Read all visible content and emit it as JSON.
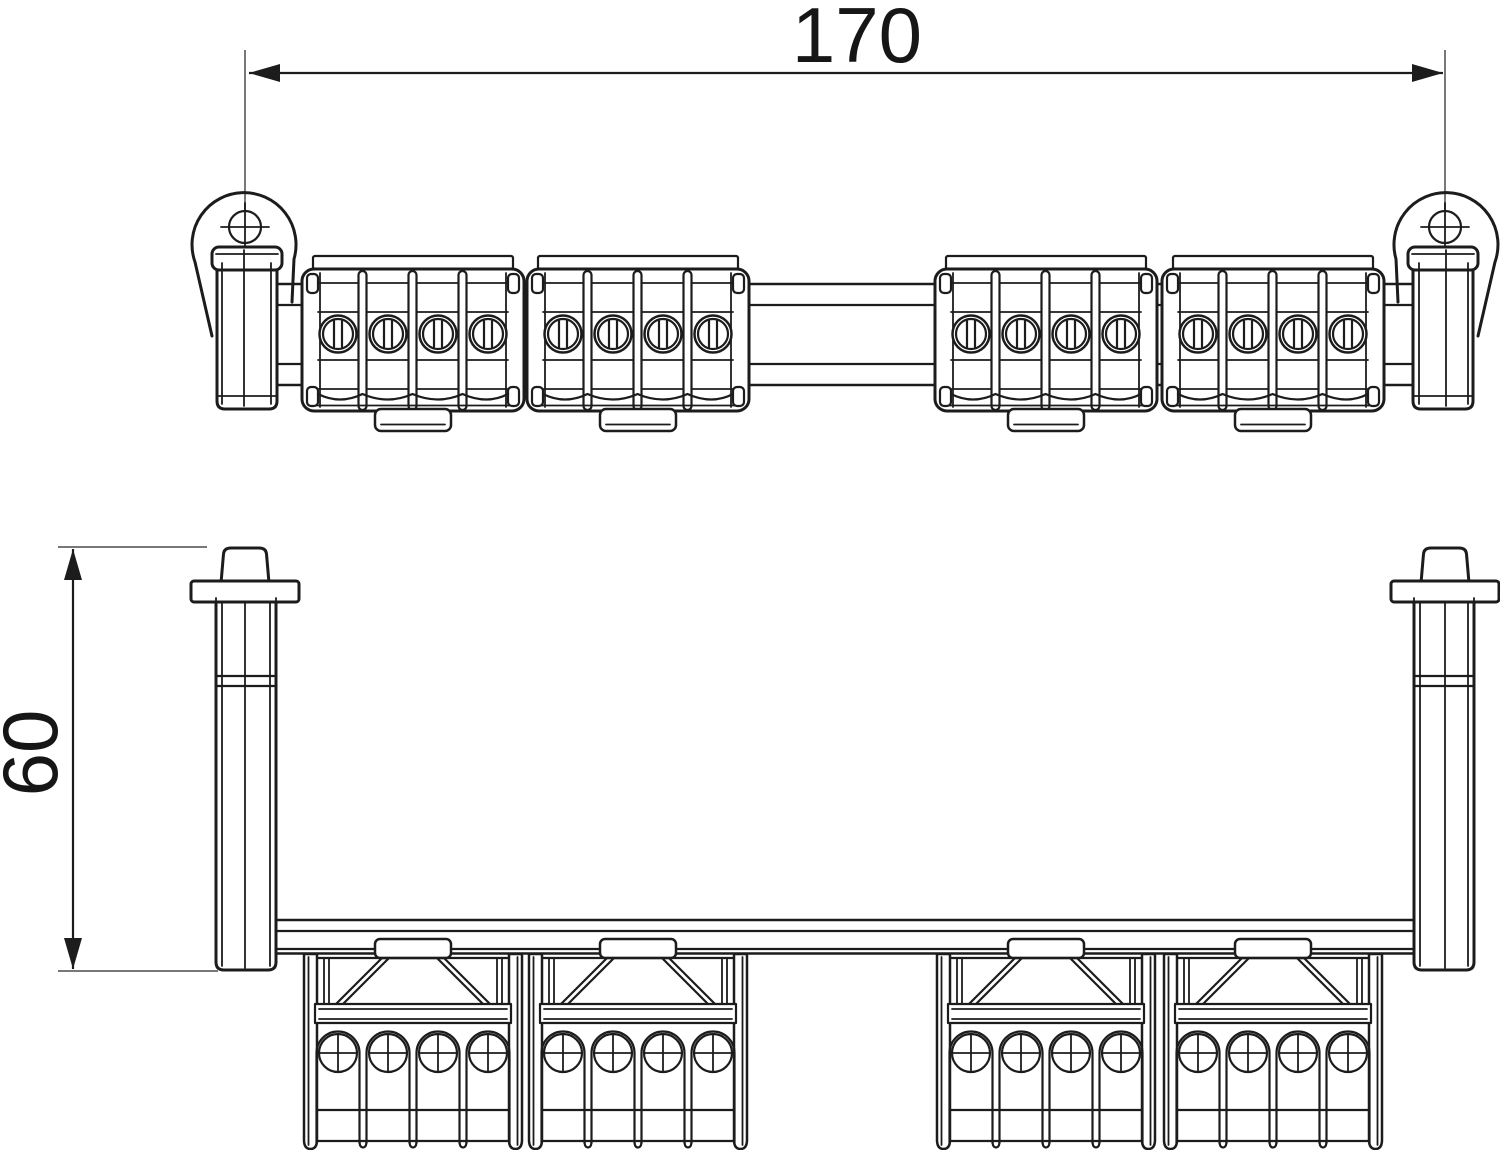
{
  "drawing": {
    "dimensions": {
      "width": {
        "label": "170"
      },
      "height": {
        "label": "60"
      }
    },
    "colors": {
      "line": "#1c1c1c",
      "extension_line": "#787878",
      "text": "#161616",
      "background": "#ffffff"
    }
  }
}
